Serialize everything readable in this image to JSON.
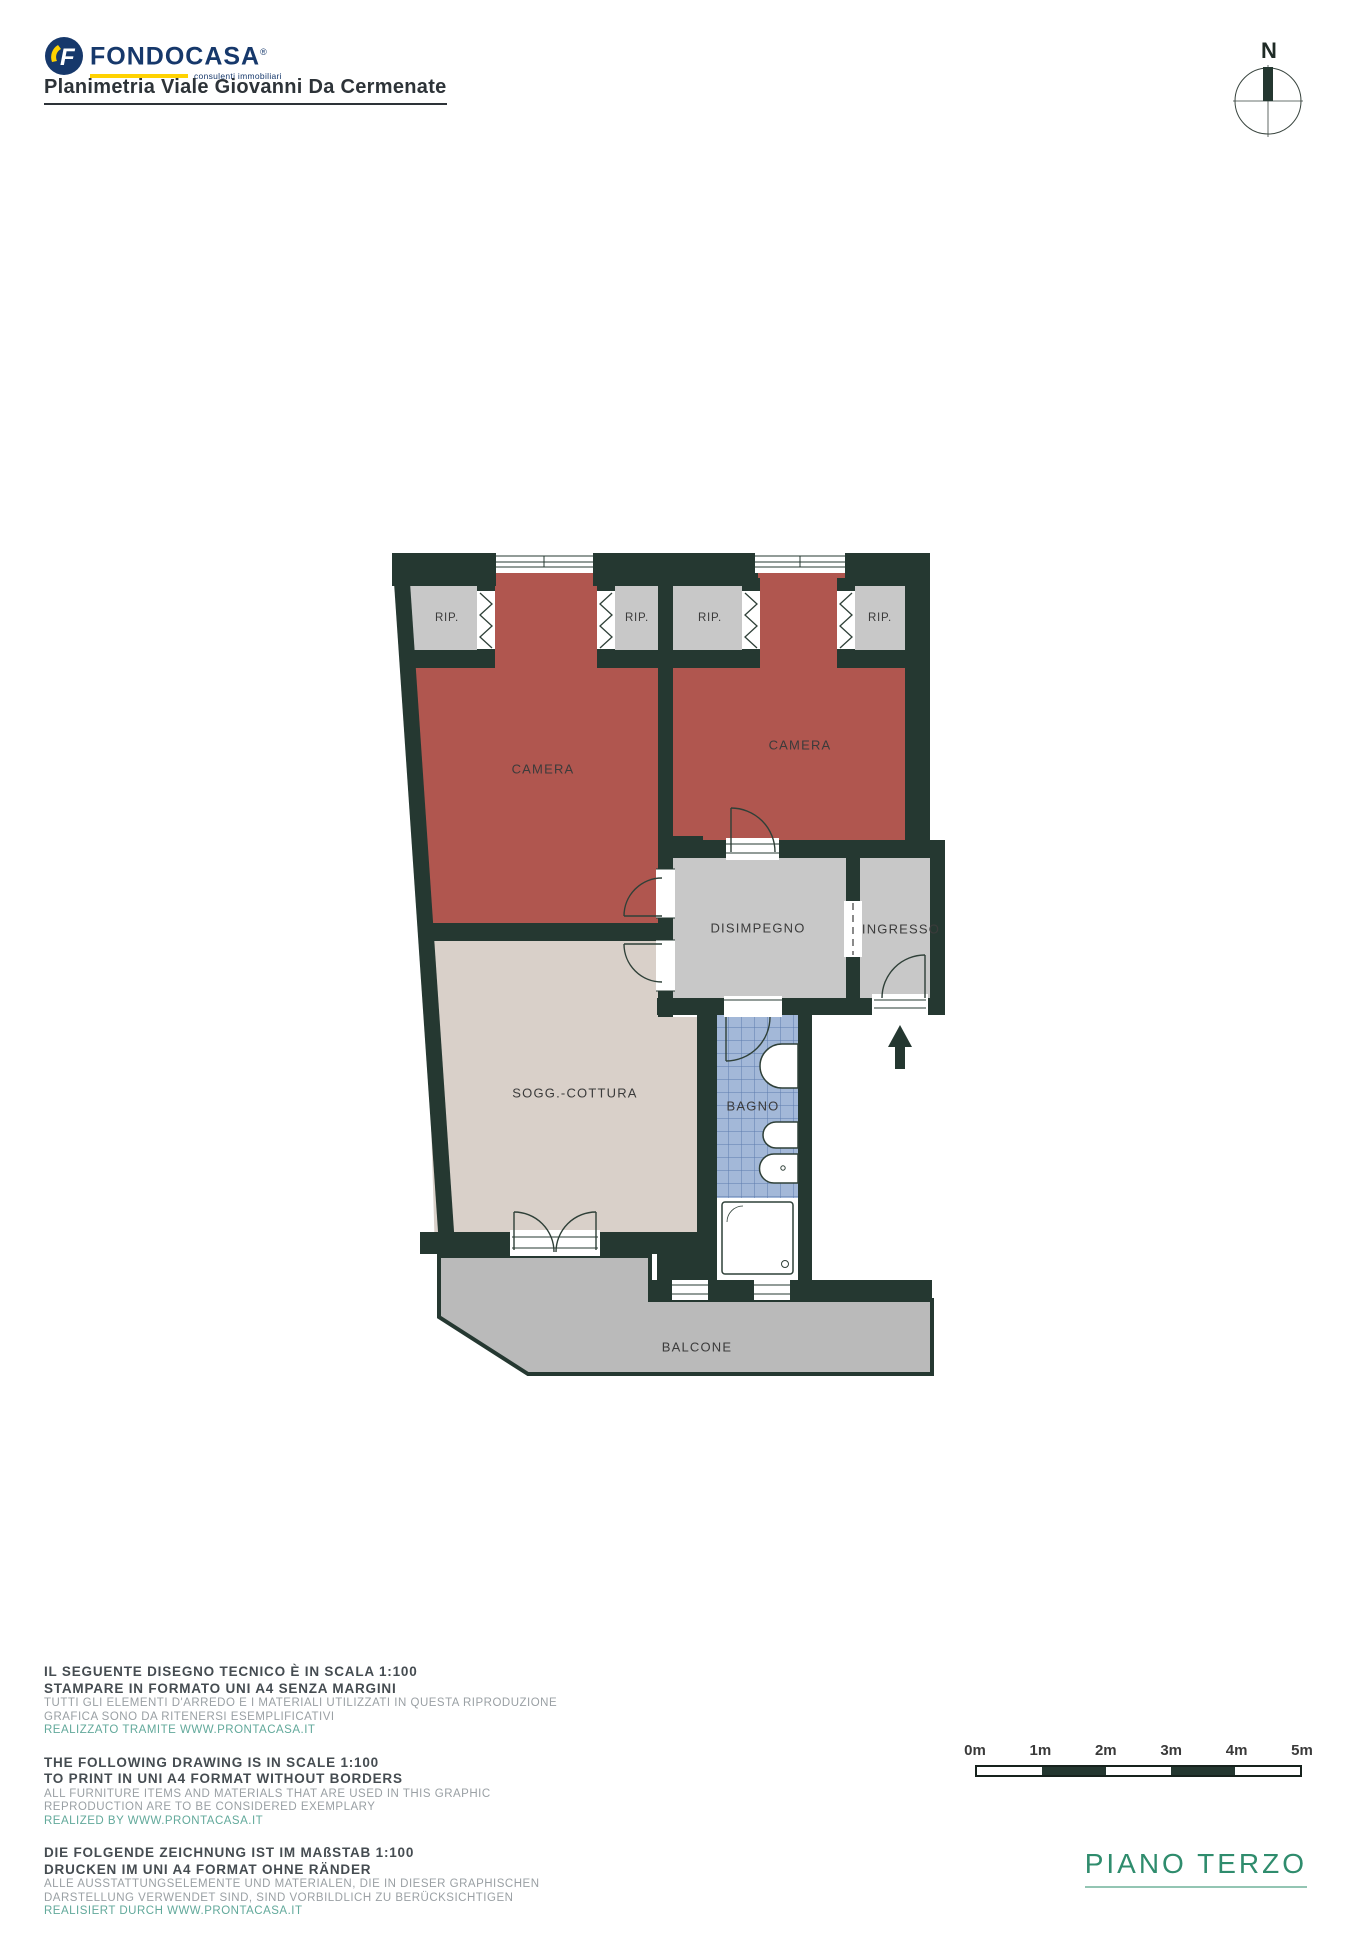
{
  "header": {
    "title": "Planimetria Viale Giovanni Da Cermenate",
    "logo": {
      "brand": "FONDOCASA",
      "registered": "®",
      "tagline": "consulenti immobiliari",
      "icon_letter": "F",
      "navy": "#16386b",
      "yellow": "#ffd200"
    }
  },
  "compass": {
    "north_label": "N"
  },
  "floorplan": {
    "colors": {
      "wall": "#253831",
      "bedroom_floor": "#b0564f",
      "living_floor": "#d9d0c9",
      "hall_floor": "#c8c8c8",
      "balcony_floor": "#bababa",
      "bath_tile": "#a3b8d8"
    },
    "labels": {
      "camera1": "CAMERA",
      "camera2": "CAMERA",
      "rip1": "RIP.",
      "rip2": "RIP.",
      "rip3": "RIP.",
      "rip4": "RIP.",
      "disimpegno": "DISIMPEGNO",
      "ingresso": "INGRESSO",
      "soggiorno": "SOGG.-COTTURA",
      "bagno": "BAGNO",
      "balcone": "BALCONE"
    }
  },
  "notes": {
    "it": {
      "line1": "IL SEGUENTE DISEGNO TECNICO È IN SCALA 1:100",
      "line2": "STAMPARE IN FORMATO UNI A4 SENZA MARGINI",
      "line3": "TUTTI GLI ELEMENTI D'ARREDO E I MATERIALI UTILIZZATI IN QUESTA RIPRODUZIONE",
      "line4": "GRAFICA SONO DA RITENERSI ESEMPLIFICATIVI",
      "line5": "REALIZZATO TRAMITE WWW.PRONTACASA.IT"
    },
    "en": {
      "line1": "THE FOLLOWING DRAWING IS IN SCALE 1:100",
      "line2": "TO PRINT IN UNI A4 FORMAT WITHOUT BORDERS",
      "line3": "ALL FURNITURE ITEMS AND MATERIALS THAT ARE USED IN THIS GRAPHIC",
      "line4": "REPRODUCTION ARE TO BE CONSIDERED EXEMPLARY",
      "line5": "REALIZED BY WWW.PRONTACASA.IT"
    },
    "de": {
      "line1": "DIE FOLGENDE ZEICHNUNG IST IM MAßSTAB 1:100",
      "line2": "DRUCKEN IM UNI A4 FORMAT OHNE RÄNDER",
      "line3": "ALLE AUSSTATTUNGSELEMENTE UND MATERIALEN, DIE IN DIESER GRAPHISCHEN",
      "line4": "DARSTELLUNG VERWENDET SIND, SIND VORBILDLICH ZU BERÜCKSICHTIGEN",
      "line5": "REALISIERT DURCH WWW.PRONTACASA.IT"
    }
  },
  "scalebar": {
    "labels": [
      "0m",
      "1m",
      "2m",
      "3m",
      "4m",
      "5m"
    ]
  },
  "floor_label": "PIANO TERZO"
}
